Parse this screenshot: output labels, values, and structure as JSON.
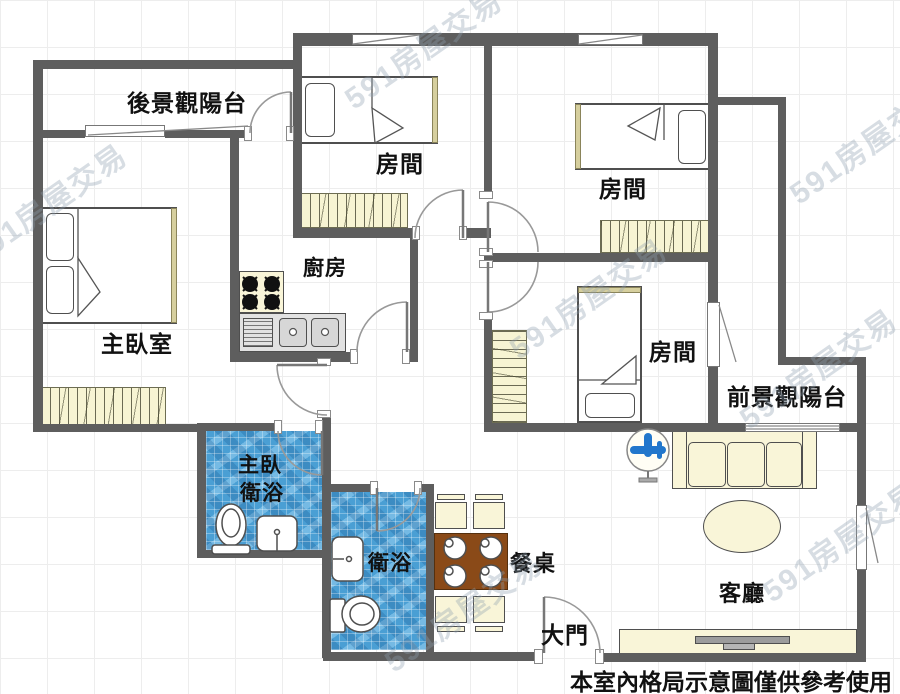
{
  "labels": {
    "rear_balcony": "後景觀陽台",
    "bedroom": "房間",
    "master_bedroom": "主臥室",
    "kitchen": "廚房",
    "front_balcony": "前景觀陽台",
    "master_bath_line1": "主臥",
    "master_bath_line2": "衛浴",
    "bath": "衛浴",
    "dining_table": "餐桌",
    "main_door": "大門",
    "living_room": "客廳"
  },
  "disclaimer": "本室內格局示意圖僅供參考使用",
  "watermark": "591房屋交易",
  "colors": {
    "wall": "#5e5e5e",
    "bath_tile": "#4a9fd4",
    "furniture_cream": "#f9f5d8",
    "table_wood": "#8a4a18",
    "fan_blue": "#2277cc"
  }
}
